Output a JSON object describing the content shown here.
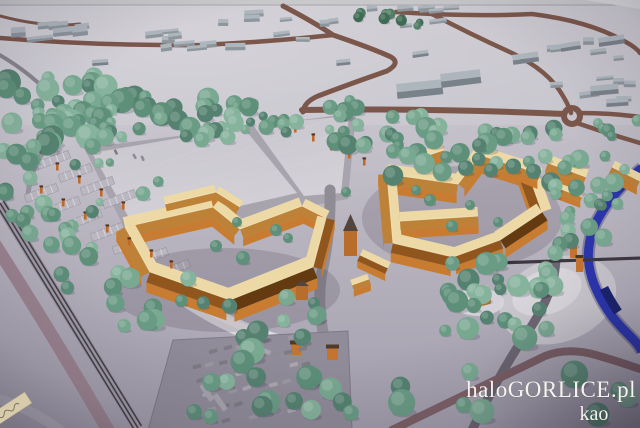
{
  "watermark": {
    "line1": "haloGORLICE.pl",
    "line2": "kao"
  },
  "palette": {
    "terrainTop": "#c9c6cd",
    "terrainMid": "#b8b4bf",
    "terrainBot": "#a39eac",
    "plateau": "#cbc8cf",
    "roadBrown": "#7b564b",
    "roadGray": "#8f8c96",
    "roadDark": "#6b6671",
    "roadMaroon": "#7c6066",
    "roadThin": "#3c3740",
    "railBand": "#a09ca6",
    "railLine": "#45404a",
    "roadMauve": "#9c8490",
    "fieldA": "#c9c6ce",
    "fieldB": "#d3d1d7",
    "fieldEdge": "#a7a4ae",
    "parkLot": "#918c99",
    "crescent": "#dcdae0",
    "mound": "#c9c6cd",
    "moundHi": "#d8d6db",
    "river": "#2b35ad",
    "riverDark": "#19226e",
    "bridge": "#36313a",
    "roofLight": "#ecd9a6",
    "roofMid": "#bd8238",
    "roofDark": "#90561d",
    "roofVdark": "#643a10",
    "wall": "#c77c31",
    "ridge": "#f4e7bf",
    "lamp": "#c06a2a",
    "kiosk": "#c4742e",
    "kioskRoof": "#4e3a2c",
    "distWall": "#8d959d",
    "distRoof": "#aeb6bd",
    "frame": "#c9c9cc",
    "frameLine": "#8b8b92",
    "corner": "#d8d8db",
    "label": "#d6cbaa",
    "watermark": "#f6f3ee"
  },
  "scene": {
    "colors": {
      "trees": [
        "#6a9c85",
        "#5d8f79",
        "#79a991",
        "#558270",
        "#86b39c"
      ],
      "treesDark": [
        "#3f6b52",
        "#48775e",
        "#527e66"
      ],
      "cars": [
        "#8e8b95",
        "#9c99a3",
        "#7e7b85",
        "#aaa7b1"
      ]
    },
    "tree_clusters": [
      {
        "x": 0,
        "y": 76,
        "w": 125,
        "h": 72,
        "n": 40,
        "r": [
          6,
          13
        ]
      },
      {
        "x": 95,
        "y": 92,
        "w": 115,
        "h": 48,
        "n": 26,
        "r": [
          5,
          12
        ]
      },
      {
        "x": 185,
        "y": 102,
        "w": 70,
        "h": 36,
        "n": 13,
        "r": [
          5,
          10
        ]
      },
      {
        "x": 0,
        "y": 146,
        "w": 55,
        "h": 82,
        "n": 11,
        "r": [
          6,
          11
        ]
      },
      {
        "x": 58,
        "y": 162,
        "w": 110,
        "h": 80,
        "n": 8,
        "r": [
          4,
          8
        ]
      },
      {
        "x": 244,
        "y": 103,
        "w": 100,
        "h": 30,
        "n": 12,
        "r": [
          4,
          9
        ]
      },
      {
        "x": 330,
        "y": 100,
        "w": 85,
        "h": 48,
        "n": 14,
        "r": [
          5,
          10
        ]
      },
      {
        "x": 392,
        "y": 112,
        "w": 105,
        "h": 68,
        "n": 20,
        "r": [
          6,
          11
        ]
      },
      {
        "x": 478,
        "y": 128,
        "w": 92,
        "h": 58,
        "n": 15,
        "r": [
          5,
          10
        ]
      },
      {
        "x": 548,
        "y": 150,
        "w": 90,
        "h": 55,
        "n": 14,
        "r": [
          5,
          10
        ]
      },
      {
        "x": 552,
        "y": 196,
        "w": 55,
        "h": 48,
        "n": 9,
        "r": [
          5,
          9
        ]
      },
      {
        "x": 348,
        "y": 12,
        "w": 72,
        "h": 14,
        "n": 9,
        "r": [
          3,
          6
        ],
        "dark": true
      },
      {
        "x": 18,
        "y": 212,
        "w": 55,
        "h": 42,
        "n": 7,
        "r": [
          6,
          10
        ]
      },
      {
        "x": 60,
        "y": 240,
        "w": 70,
        "h": 48,
        "n": 7,
        "r": [
          6,
          10
        ]
      },
      {
        "x": 112,
        "y": 278,
        "w": 78,
        "h": 52,
        "n": 8,
        "r": [
          6,
          11
        ]
      },
      {
        "x": 195,
        "y": 296,
        "w": 130,
        "h": 42,
        "n": 9,
        "r": [
          5,
          9
        ]
      },
      {
        "x": 170,
        "y": 318,
        "w": 175,
        "h": 100,
        "n": 17,
        "r": [
          7,
          13
        ]
      },
      {
        "x": 438,
        "y": 252,
        "w": 125,
        "h": 80,
        "n": 26,
        "r": [
          6,
          12
        ]
      },
      {
        "x": 345,
        "y": 335,
        "w": 290,
        "h": 88,
        "n": 11,
        "r": [
          8,
          14
        ]
      },
      {
        "x": 588,
        "y": 118,
        "w": 50,
        "h": 28,
        "n": 5,
        "r": [
          4,
          7
        ]
      }
    ],
    "tree_singles": [
      [
        216,
        246,
        6
      ],
      [
        243,
        258,
        7
      ],
      [
        276,
        230,
        6
      ],
      [
        288,
        238,
        5
      ],
      [
        237,
        222,
        5
      ],
      [
        430,
        200,
        6
      ],
      [
        416,
        190,
        5
      ],
      [
        452,
        226,
        6
      ],
      [
        470,
        205,
        5
      ],
      [
        346,
        192,
        5
      ],
      [
        498,
        222,
        5
      ]
    ],
    "distant_bands": [
      {
        "x": 95,
        "y": 10,
        "w": 245,
        "h": 42,
        "n": 17,
        "wr": [
          9,
          22
        ],
        "hr": [
          4,
          8
        ]
      },
      {
        "x": 350,
        "y": 4,
        "w": 130,
        "h": 26,
        "n": 8,
        "wr": [
          8,
          18
        ],
        "hr": [
          4,
          7
        ]
      },
      {
        "x": 545,
        "y": 34,
        "w": 95,
        "h": 85,
        "n": 11,
        "wr": [
          8,
          20
        ],
        "hr": [
          4,
          8
        ]
      },
      {
        "x": 5,
        "y": 8,
        "w": 85,
        "h": 48,
        "n": 7,
        "wr": [
          12,
          30
        ],
        "hr": [
          5,
          10
        ]
      }
    ],
    "warehouses": [
      [
        396,
        84,
        46,
        15,
        -6
      ],
      [
        440,
        74,
        40,
        14,
        -7
      ],
      [
        512,
        55,
        26,
        10,
        -8
      ],
      [
        560,
        44,
        20,
        8,
        -9
      ],
      [
        590,
        86,
        28,
        10,
        -5
      ],
      [
        606,
        99,
        22,
        8,
        -4
      ],
      [
        598,
        38,
        26,
        9,
        -8
      ],
      [
        412,
        52,
        16,
        6,
        -8
      ],
      [
        336,
        60,
        14,
        6,
        -6
      ],
      [
        92,
        60,
        16,
        6,
        -4
      ]
    ],
    "complexes": {
      "left": {
        "wings": [
          [
            125,
            227,
            213,
            207,
            20
          ],
          [
            213,
            207,
            240,
            229,
            18
          ],
          [
            240,
            229,
            302,
            206,
            18
          ],
          [
            302,
            206,
            326,
            218,
            16
          ],
          [
            326,
            218,
            313,
            267,
            18,
            "dark"
          ],
          [
            313,
            267,
            230,
            300,
            24,
            "vdark"
          ],
          [
            230,
            300,
            150,
            272,
            22,
            "dark"
          ],
          [
            150,
            272,
            125,
            227,
            20
          ],
          [
            165,
            204,
            216,
            192,
            15
          ],
          [
            216,
            192,
            240,
            207,
            13
          ]
        ],
        "shadow": [
          225,
          290,
          115,
          42
        ]
      },
      "right": {
        "wings": [
          [
            387,
            174,
            458,
            184,
            20
          ],
          [
            458,
            184,
            480,
            155,
            16
          ],
          [
            480,
            155,
            527,
            170,
            18
          ],
          [
            527,
            170,
            542,
            212,
            20,
            "dark"
          ],
          [
            542,
            212,
            500,
            240,
            20,
            "vdark"
          ],
          [
            500,
            240,
            453,
            257,
            18,
            "dark"
          ],
          [
            453,
            257,
            393,
            243,
            20,
            "dark"
          ],
          [
            393,
            243,
            387,
            174,
            18
          ],
          [
            400,
            221,
            478,
            216,
            18
          ],
          [
            420,
            158,
            444,
            150,
            13
          ],
          [
            360,
            255,
            388,
            268,
            13,
            "dark"
          ]
        ],
        "shadow": [
          462,
          218,
          100,
          52
        ]
      },
      "east_houses": {
        "wings": [
          [
            510,
            163,
            540,
            175,
            14
          ],
          [
            548,
            163,
            586,
            177,
            16
          ],
          [
            558,
            188,
            582,
            197,
            10
          ],
          [
            612,
            167,
            640,
            181,
            14
          ]
        ]
      },
      "south_small": {
        "wings": [
          [
            470,
            297,
            489,
            291,
            12
          ],
          [
            352,
            285,
            369,
            279,
            11
          ]
        ]
      }
    },
    "towers": [
      {
        "x": 344,
        "y": 231,
        "w": 13,
        "h": 25,
        "spire": 17
      },
      {
        "x": 296,
        "y": 286,
        "w": 12,
        "h": 14,
        "spire": 6
      }
    ],
    "kiosks": [
      [
        291,
        343,
        10,
        12
      ],
      [
        327,
        347,
        11,
        13
      ]
    ],
    "pylons": [
      [
        570,
        243
      ],
      [
        576,
        257
      ]
    ],
    "lamps": [
      [
        34,
        151
      ],
      [
        56,
        164
      ],
      [
        78,
        177
      ],
      [
        100,
        190
      ],
      [
        122,
        203
      ],
      [
        40,
        187
      ],
      [
        62,
        200
      ],
      [
        84,
        213
      ],
      [
        106,
        226
      ],
      [
        128,
        239
      ],
      [
        150,
        251
      ],
      [
        170,
        262
      ],
      [
        294,
        126
      ],
      [
        312,
        135
      ],
      [
        330,
        144
      ],
      [
        348,
        152
      ],
      [
        363,
        159
      ],
      [
        232,
        117
      ]
    ],
    "stall_rows": [
      [
        14,
        149
      ],
      [
        36,
        162
      ],
      [
        58,
        175
      ],
      [
        80,
        188
      ],
      [
        102,
        201
      ],
      [
        24,
        195
      ],
      [
        46,
        208
      ],
      [
        68,
        221
      ],
      [
        90,
        234
      ],
      [
        112,
        247
      ],
      [
        134,
        259
      ],
      [
        156,
        271
      ]
    ],
    "car_rows": [
      {
        "x": 196,
        "y": 352,
        "n": 9
      },
      {
        "x": 192,
        "y": 366,
        "n": 10
      },
      {
        "x": 196,
        "y": 380,
        "n": 9
      },
      {
        "x": 202,
        "y": 394,
        "n": 9
      },
      {
        "x": 208,
        "y": 408,
        "n": 8
      },
      {
        "x": 221,
        "y": 420,
        "n": 7
      },
      {
        "x": 108,
        "y": 146,
        "n": 5,
        "dx": 8.6,
        "dy": 2.2,
        "w": 5.5,
        "h": 2.6,
        "rot": 62
      }
    ],
    "buses": [
      [
        204,
        383,
        57,
        19,
        5.5
      ],
      [
        217,
        393,
        55,
        19,
        5.5
      ],
      [
        258,
        346,
        20,
        14,
        4.5
      ]
    ]
  }
}
